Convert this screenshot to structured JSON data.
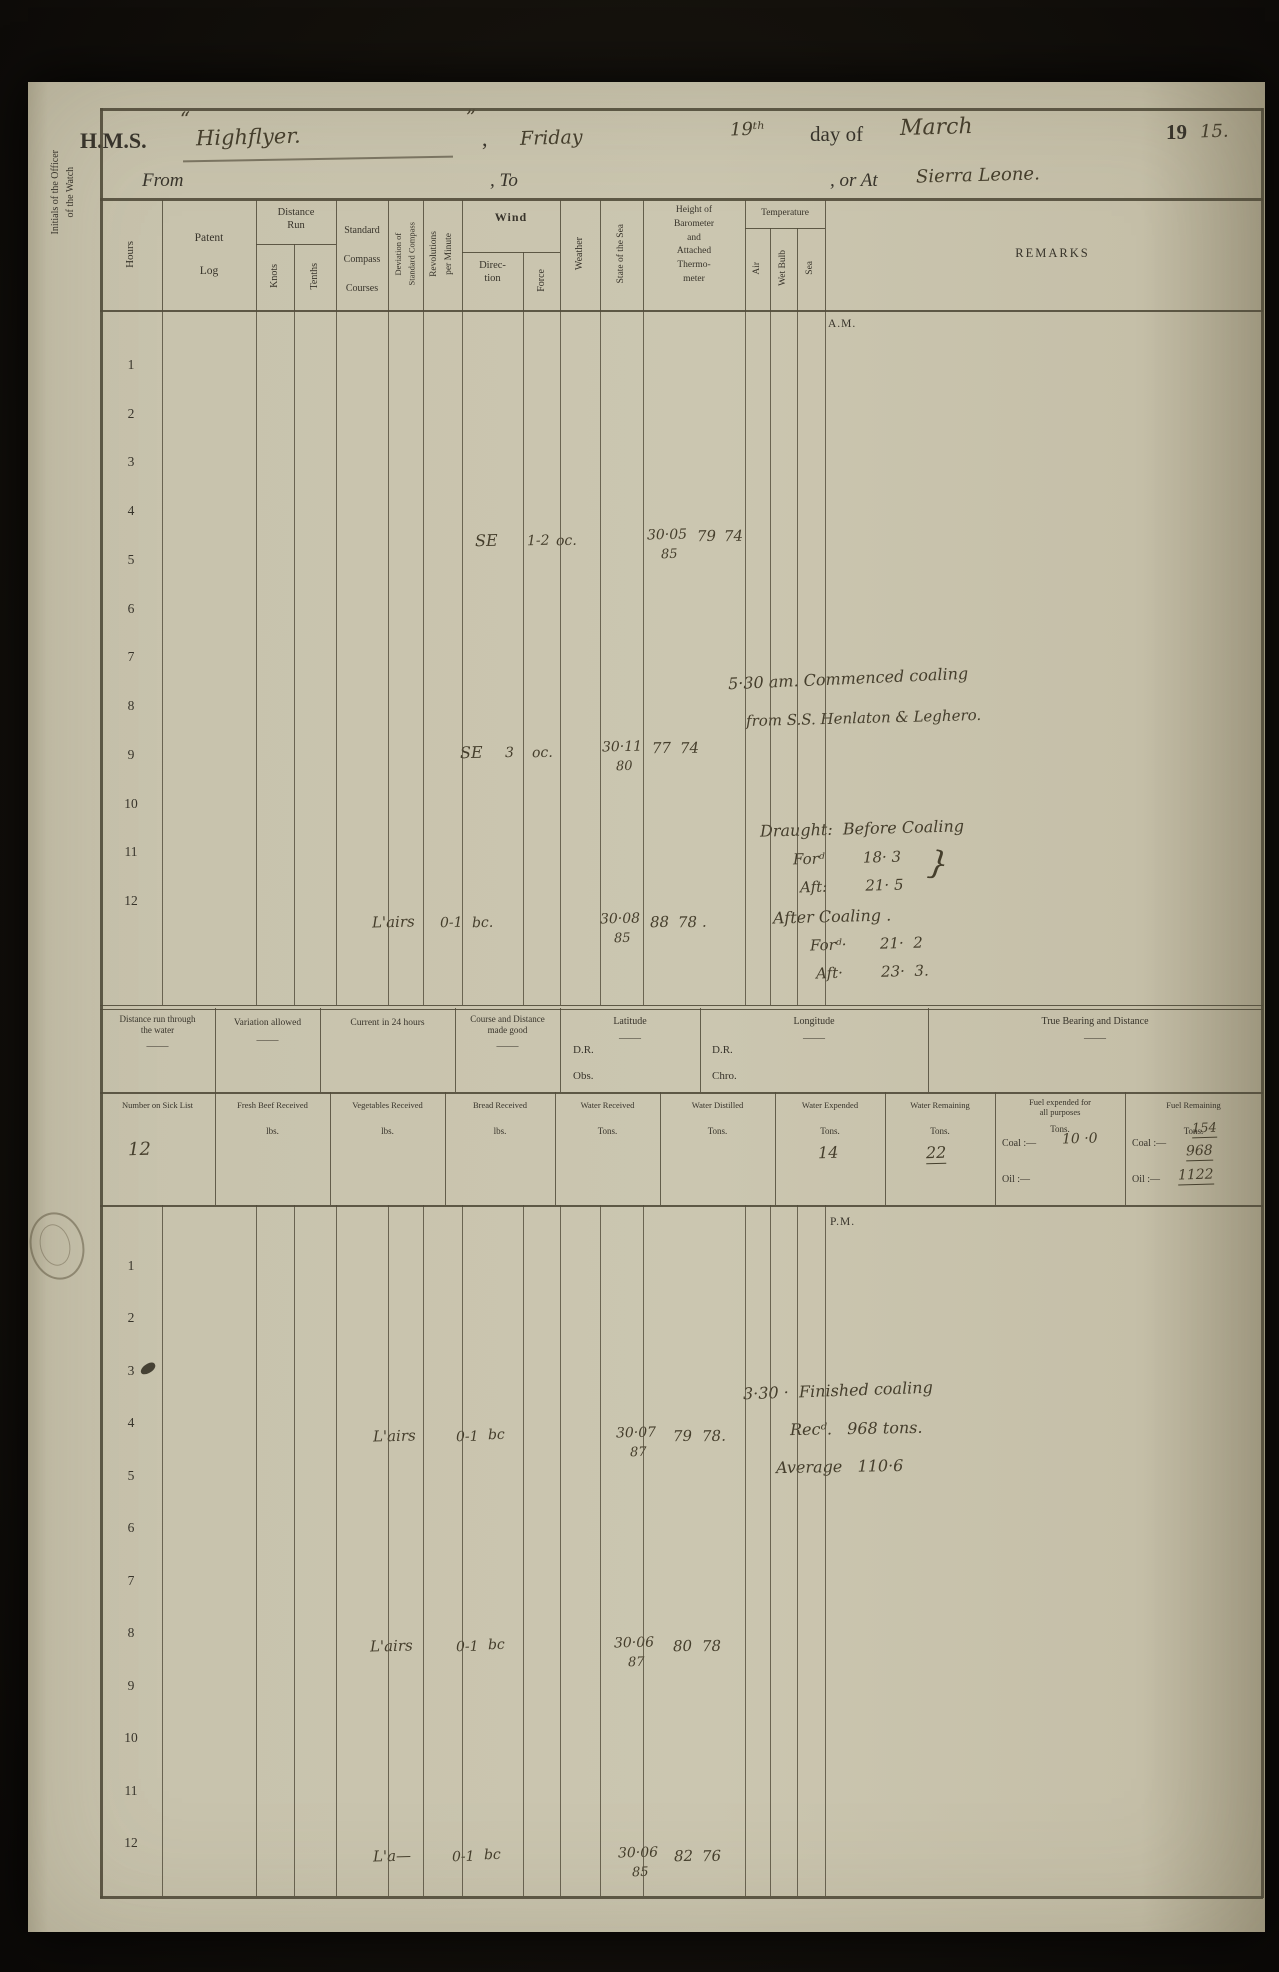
{
  "margin_note": "Initials of the Officer\nof the Watch",
  "header": {
    "hms": "H.M.S.",
    "open_quote": "“",
    "ship": "Highflyer.",
    "close_quote": "”",
    "comma": ",",
    "weekday": "Friday",
    "day": "19ᵗʰ",
    "day_of": "day of",
    "month": "March",
    "year_printed": "19",
    "year_written": "15.",
    "from_label": "From",
    "to_label": ",  To",
    "or_at_label": ",  or At",
    "place": "Sierra Leone."
  },
  "columns": {
    "hours": "Hours",
    "patent_log": "Patent\nLog",
    "distance_run": "Distance\nRun",
    "knots": "Knots",
    "tenths": "Tenths",
    "courses": "Standard\nCompass\nCourses",
    "deviation": "Deviation of\nStandard Compass",
    "revolutions": "Revolutions\nper Minute",
    "wind": "Wind",
    "direction": "Direc-\ntion",
    "force": "Force",
    "weather": "Weather",
    "state_sea": "State of the Sea",
    "barometer": "Height of\nBarometer\nand\nAttached\nThermo-\nmeter",
    "temperature": "Temperature",
    "air": "Air",
    "wet_bulb": "Wet Bulb",
    "sea": "Sea",
    "remarks": "REMARKS"
  },
  "hours_scale": [
    "1",
    "2",
    "3",
    "4",
    "5",
    "6",
    "7",
    "8",
    "9",
    "10",
    "11",
    "12"
  ],
  "am": {
    "label": "A.M.",
    "rows": [
      {
        "dir": "SE",
        "force": "1-2",
        "wx": "oc.",
        "bar": "30·05",
        "att": "85",
        "air": "79",
        "wet": "74"
      },
      {
        "dir": "SE",
        "force": "3",
        "wx": "oc.",
        "bar": "30·11",
        "att": "80",
        "air": "77",
        "wet": "74"
      },
      {
        "dir": "L'airs",
        "force": "0-1",
        "wx": "bc.",
        "bar": "30·08",
        "att": "85",
        "air": "88",
        "wet": "78 ."
      }
    ],
    "remarks": {
      "coaling_1": "5·30 am. Commenced coaling",
      "coaling_2": "from S.S. Henlaton & Leghero.",
      "draught_title": "Draught:  Before Coaling",
      "fwd_before": "Forᵈ        18· 3",
      "aft_before": "Aft:        21· 5",
      "brace": "}",
      "after_title": "After Coaling .",
      "fwd_after": "Forᵈ·       21·  2",
      "aft_after": "Aft·        23·  3."
    }
  },
  "summary": {
    "boxes": [
      "Distance run through\nthe water",
      "Variation allowed",
      "Current in 24 hours",
      "Course and Distance\nmade good",
      "Latitude",
      "Longitude",
      "True Bearing and Distance"
    ],
    "dr_lat": "D.R.",
    "obs": "Obs.",
    "dr_lon": "D.R.",
    "chro": "Chro."
  },
  "stats": {
    "headers": [
      "Number on Sick List",
      "Fresh Beef Received",
      "Vegetables Received",
      "Bread Received",
      "Water Received",
      "Water Distilled",
      "Water Expended",
      "Water Remaining",
      "Fuel expended for\nall purposes",
      "Fuel Remaining"
    ],
    "units": [
      "lbs.",
      "lbs.",
      "lbs.",
      "Tons.",
      "Tons.",
      "Tons.",
      "Tons.",
      "Tons.",
      "Tons."
    ],
    "sick_list": "12",
    "water_expended": "14",
    "water_remaining": "22",
    "coal_label": "Coal :—",
    "oil_label": "Oil :—",
    "fuel_expended_coal": "10 ·0",
    "fuel_remaining_coal_prev": "154",
    "fuel_remaining_coal_recd": "968",
    "fuel_remaining_total": "1122"
  },
  "pm": {
    "label": "P.M.",
    "rows": [
      {
        "dir": "L'airs",
        "force": "0-1",
        "wx": "bc",
        "bar": "30·07",
        "att": "87",
        "air": "79",
        "wet": "78."
      },
      {
        "dir": "L'airs",
        "force": "0-1",
        "wx": "bc",
        "bar": "30·06",
        "att": "87",
        "air": "80",
        "wet": "78"
      },
      {
        "dir": "L'a—",
        "force": "0-1",
        "wx": "bc",
        "bar": "30·06",
        "att": "85",
        "air": "82",
        "wet": "76"
      }
    ],
    "remarks": {
      "l1": "3·30 ·  Finished coaling",
      "l2": "Recᵈ.   968 tons.",
      "l3": "Average   110·6"
    }
  }
}
